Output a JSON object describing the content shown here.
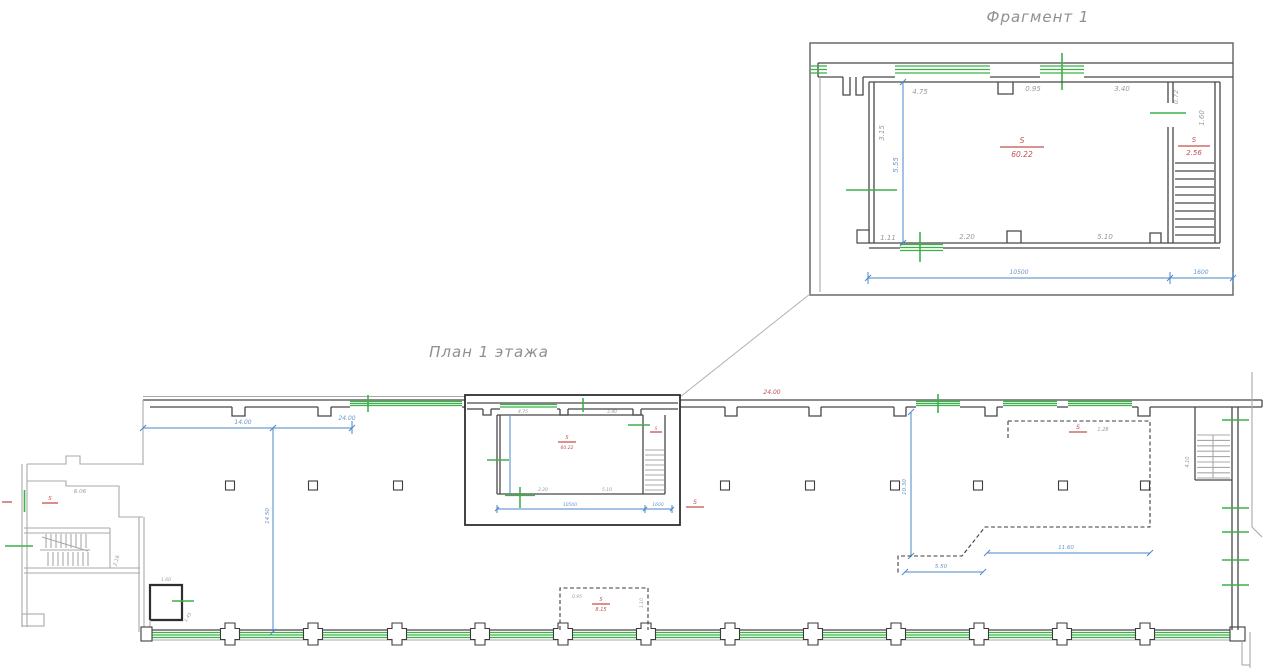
{
  "colors": {
    "wall": "#474747",
    "window_green": "#3cb049",
    "dimension_blue": "#4a86c8",
    "area_red": "#c4504e",
    "text_gray": "#9a9a9a"
  },
  "fragment": {
    "title": "Фрагмент 1",
    "dims": {
      "top1": "4.75",
      "top2": "0.95",
      "top3": "3.40",
      "left1": "3.15",
      "left2": "5.55",
      "right1": "0.72",
      "right2": "1.60",
      "bottom1": "1.11",
      "bottom2": "2.20",
      "bottom3": "5.10",
      "overall1": "10500",
      "overall2": "1600"
    },
    "areas": {
      "main_label": "S",
      "main_value": "60.22",
      "stair_label": "S",
      "stair_value": "2.56"
    }
  },
  "plan": {
    "title": "План 1 этажа",
    "dims": {
      "top_left": "14.00",
      "top_left_end": "24.00",
      "top_red": "24.00",
      "left_vertical": "14.50",
      "mid_vertical": "10.30",
      "dashed_width": "11.60",
      "dashed_small": "5.50",
      "dashed_side": "1.28",
      "annex_top": "6.06",
      "annex_inner": "2.16",
      "vestibule_w": "1.60",
      "vestibule_h": "1.45",
      "stair_right": "4.10",
      "booth_w": "0.95",
      "booth_h": "1.10"
    },
    "areas": {
      "annex_label": "S",
      "hall_label": "S",
      "dashed_label": "S",
      "booth_label": "S",
      "booth_value": "8.15"
    },
    "mini": {
      "top1": "4.75",
      "top2": "3.40",
      "bottom1": "2.20",
      "bottom2": "5.10",
      "overall1": "10500",
      "overall2": "1600",
      "area_label": "S",
      "area_value": "60.22",
      "stair_label": "S"
    }
  }
}
